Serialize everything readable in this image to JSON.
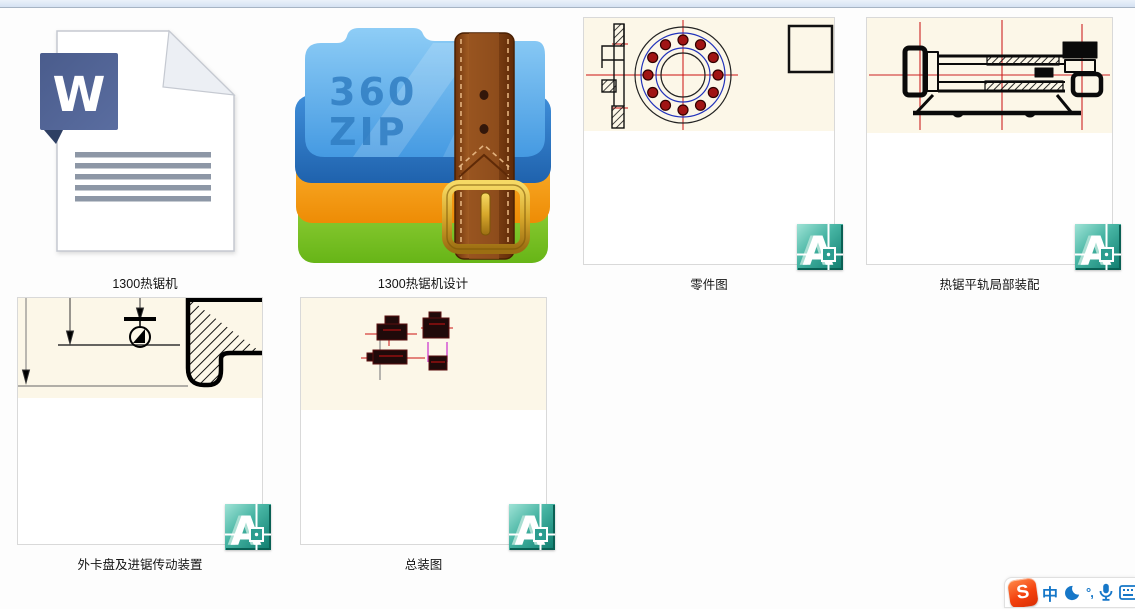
{
  "files": [
    {
      "label": "1300热锯机",
      "icon": "word-document-icon",
      "glyph": "W"
    },
    {
      "label": "1300热锯机设计",
      "icon": "360zip-archive-icon",
      "overlay_line1": "360",
      "overlay_line2": "ZIP"
    },
    {
      "label": "零件图",
      "icon": "dwg-thumbnail"
    },
    {
      "label": "热锯平轨局部装配",
      "icon": "dwg-thumbnail"
    },
    {
      "label": "外卡盘及进锯传动装置",
      "icon": "dwg-thumbnail"
    },
    {
      "label": "总装图",
      "icon": "dwg-thumbnail"
    }
  ],
  "dwg_badge": {
    "letter": "A"
  },
  "ime_toolbar": {
    "logo_letter": "S",
    "language_indicator": "中",
    "punctuation_indicator": "°,",
    "icons": [
      "sogou-logo",
      "chinese-english-toggle",
      "night-mode-moon-icon",
      "punctuation-mode-icon",
      "voice-input-mic-icon",
      "virtual-keyboard-icon"
    ]
  },
  "colors": {
    "top_strip": "#dce8f5",
    "word_blue": "#4e6191",
    "zip_blue": "#58a7e8",
    "zip_orange": "#f59c1a",
    "zip_green": "#7cc431",
    "belt_brown": "#8a4a1a",
    "buckle_gold": "#d8a92c",
    "autocad_teal": "#2a9d8f",
    "drawing_paper": "#fcf7e8",
    "centerline_red": "#cc1111",
    "ime_blue": "#1677c8",
    "sogou_orange": "#f4420e"
  }
}
